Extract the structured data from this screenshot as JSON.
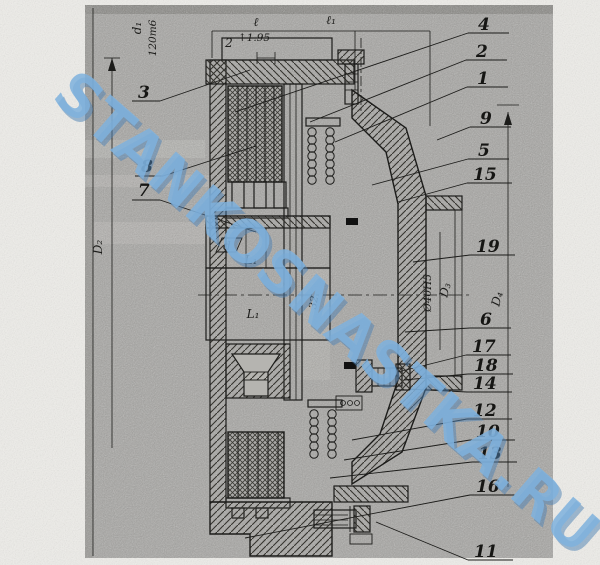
{
  "watermark": {
    "text": "STANKOSNASTKA.RU",
    "color": "#7fb2de"
  },
  "dimension_labels": {
    "length_l": "ℓ",
    "length_l1": "ℓ₁",
    "note_count": "2",
    "note_value": "↑1.95",
    "shaft_d1": "d₁",
    "shaft_fit": "120m6",
    "diameter_D2": "D₂",
    "bore_d": "d",
    "hub_L1": "L₁",
    "body_L1": "L₁",
    "width_32": "32",
    "bore_fit": "Ø40H5",
    "diameter_D3": "D₃",
    "diameter_D4": "D₄"
  },
  "callouts": {
    "left": [
      "3",
      "8",
      "7"
    ],
    "right": [
      "4",
      "2",
      "1",
      "9",
      "5",
      "15",
      "19",
      "6",
      "17",
      "18",
      "14",
      "12",
      "10",
      "13",
      "16",
      "11"
    ]
  }
}
